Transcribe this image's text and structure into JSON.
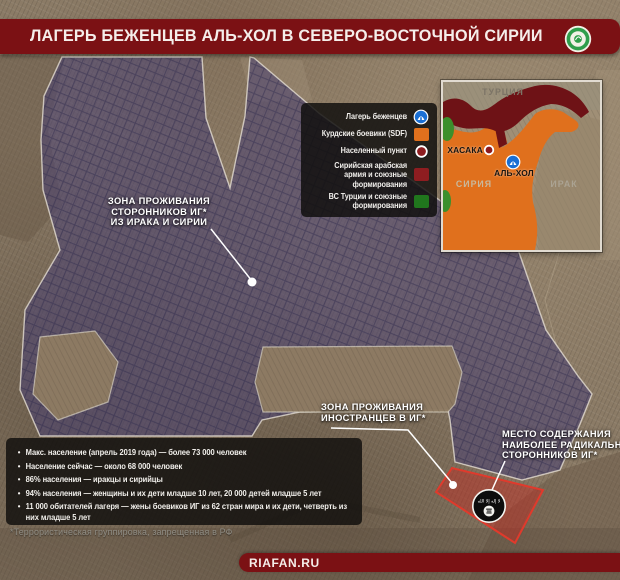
{
  "header": {
    "title": "ЛАГЕРЬ БЕЖЕНЦЕВ АЛЬ-ХОЛ В СЕВЕРО-ВОСТОЧНОЙ СИРИИ",
    "logo": "fan-news-agency-logo"
  },
  "legend": {
    "items": [
      {
        "label": "Лагерь беженцев",
        "icon": "refugee-camp-marker"
      },
      {
        "label": "Курдские боевики (SDF)",
        "icon": "orange-square"
      },
      {
        "label": "Населенный пункт",
        "icon": "settlement-marker"
      },
      {
        "label": "Сирийская арабская армия и союзные формирования",
        "icon": "dark-red-square"
      },
      {
        "label": "ВС Турции и союзные формирования",
        "icon": "green-square"
      }
    ]
  },
  "inset_map": {
    "countries": [
      {
        "name": "ТУРЦИЯ"
      },
      {
        "name": "СИРИЯ"
      },
      {
        "name": "ИРАК"
      }
    ],
    "cities": [
      {
        "name": "ХАСАКА",
        "marker": "settlement"
      },
      {
        "name": "АЛЬ-ХОЛ",
        "marker": "refugee-camp"
      }
    ]
  },
  "map_labels": {
    "zone_iraq_syria": {
      "lines": [
        "ЗОНА ПРОЖИВАНИЯ",
        "СТОРОННИКОВ ИГ*",
        "ИЗ ИРАКА И СИРИИ"
      ]
    },
    "zone_foreigners": {
      "lines": [
        "ЗОНА ПРОЖИВАНИЯ",
        "ИНОСТРАНЦЕВ В ИГ*"
      ]
    },
    "zone_radicals": {
      "lines": [
        "МЕСТО СОДЕРЖАНИЯ",
        "НАИБОЛЕЕ РАДИКАЛЬНЫХ",
        "СТОРОННИКОВ ИГ*"
      ]
    }
  },
  "stats": {
    "bullets": [
      "Макс. население (апрель 2019 года) — более 73 000 человек",
      "Население сейчас — около 68 000 человек",
      "86% населения — иракцы и сирийцы",
      "94% населения — женщины и их дети младше 10 лет, 20 000 детей младше 5 лет",
      "11 000 обитателей лагеря — жены боевиков ИГ из 62 стран мира и их дети, четверть из них младше 5 лет"
    ]
  },
  "footnote": "*Террористическая группировка, запрещенная в РФ",
  "footer": {
    "site": "RIAFAN.RU"
  },
  "colors": {
    "header_red": "#7b1114",
    "sdf_orange": "#e0701d",
    "syrian_army_dark_red": "#8e1d20",
    "turkey_green": "#20761d",
    "camp_blue": "#1a6fd4",
    "camp_zone_purple": "#4b4472",
    "radical_zone_red": "#e03a2c"
  }
}
